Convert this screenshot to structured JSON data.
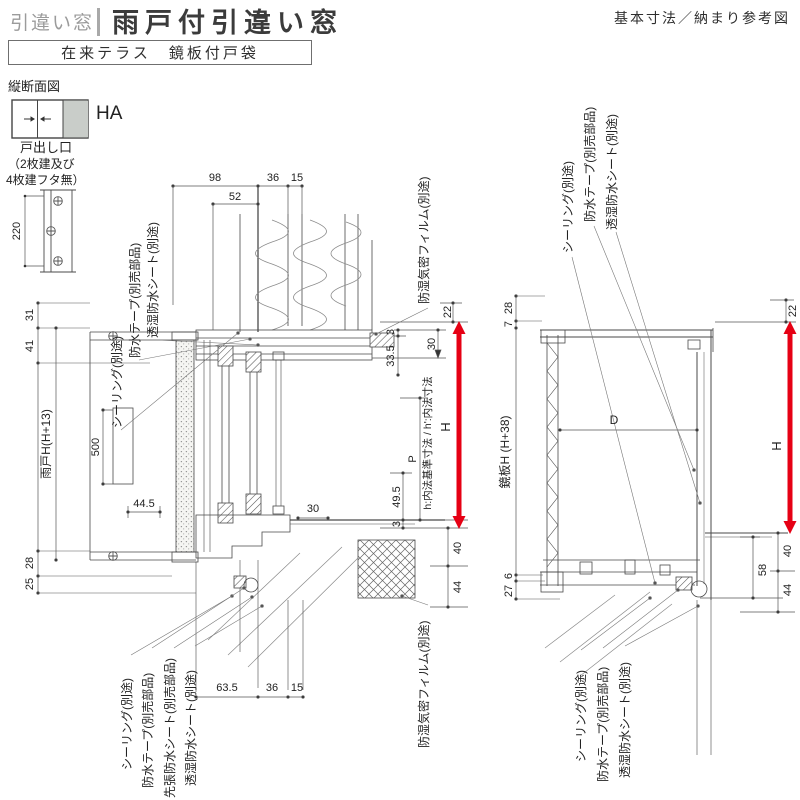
{
  "header": {
    "category": "引違い窓",
    "title": "雨戸付引違い窓",
    "subtitle": "在来テラス　鏡板付戸袋",
    "corner_note": "基本寸法／納まり参考図",
    "section_label": "縦断面図"
  },
  "legend": {
    "type_code": "HA",
    "note_line1": "戸出し口",
    "note_line2": "（2枚建及び",
    "note_line3": "4枚建フタ無）",
    "dim_220": "220"
  },
  "left": {
    "callouts_top": [
      "シーリング(別途)",
      "防水テープ(別売部品)",
      "透湿防水シート(別途)"
    ],
    "film_top": "防湿気密フィルム(別途)",
    "callouts_bottom": [
      "シーリング(別途)",
      "防水テープ(別売部品)",
      "先張防水シート(別売部品)",
      "透湿防水シート(別途)"
    ],
    "film_bottom": "防湿気密フィルム(別途)",
    "dims": {
      "d98": "98",
      "d36_top": "36",
      "d15_top": "15",
      "d52": "52",
      "d31": "31",
      "d41": "41",
      "amado_h": "雨戸H(H+13)",
      "d28": "28",
      "d25": "25",
      "d500": "500",
      "d44_5": "44.5",
      "d30_sill": "30",
      "d22": "22",
      "d30": "30",
      "d3_head": "3",
      "d33_5": "33.5",
      "inner_note": "h:内法基準寸法 / h':内法寸法",
      "h_arrow": "H",
      "p": "P",
      "d49_5": "49.5",
      "d3_sill": "3",
      "d40": "40",
      "d44": "44",
      "d63_5": "63.5",
      "d36_bottom": "36",
      "d15_bottom": "15"
    }
  },
  "right": {
    "callouts_top": [
      "シーリング(別途)",
      "防水テープ(別売部品)",
      "透湿防水シート(別途)"
    ],
    "callouts_bottom": [
      "シーリング(別途)",
      "防水テープ(別売部品)",
      "透湿防水シート(別途)"
    ],
    "dims": {
      "d28": "28",
      "d7": "7",
      "kagami_h": "鏡板H (H+38)",
      "d6": "6",
      "d27": "27",
      "dD": "D",
      "d22": "22",
      "h_arrow": "H",
      "d58": "58",
      "d40": "40",
      "d44": "44"
    }
  },
  "colors": {
    "accent": "#e60014",
    "line": "#4a4a4a",
    "muted": "#9b9b9b"
  }
}
